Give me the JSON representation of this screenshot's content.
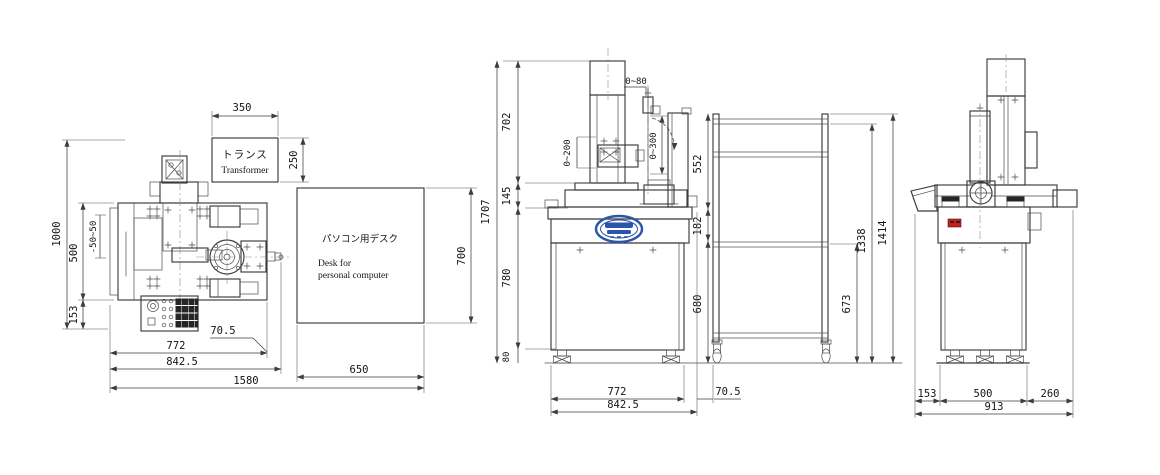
{
  "drawing_title": "machine-installation-layout-three-views",
  "colors": {
    "line": "#3a3a3a",
    "logo_blue": "#2b55a8",
    "label_red": "#bb2420"
  },
  "plan_view": {
    "transformer": {
      "label_jp": "トランス",
      "label_en": "Transformer"
    },
    "desk": {
      "label_jp": "パソコン用デスク",
      "label_en_line1": "Desk for",
      "label_en_line2": "personal computer"
    },
    "dims": {
      "transformer_width": "350",
      "transformer_depth": "250",
      "total_depth": "1000",
      "body_depth": "500",
      "table_travel": "-50~50",
      "panel_depth": "153",
      "shaft_offset": "70.5",
      "machine_width": "772",
      "machine_overall_width": "842.5",
      "desk_width": "650",
      "desk_depth": "700",
      "total_width": "1580"
    }
  },
  "front_view": {
    "dims": {
      "total_height": "1707",
      "column_height": "702",
      "column_base_height": "145",
      "cabinet_height": "780",
      "foot_height": "80",
      "head_stroke": "0~80",
      "slide_stroke": "0~200",
      "arm_stroke": "0~300",
      "frame_upper": "552",
      "frame_middle": "182",
      "frame_lower": "680",
      "shelf_height": "673",
      "frame_inner_height": "1338",
      "frame_height": "1414",
      "machine_width": "772",
      "machine_overall_width": "842.5",
      "gap_to_frame": "70.5"
    }
  },
  "side_view": {
    "dims": {
      "front_overhang": "153",
      "body_depth": "500",
      "rear_overhang": "260",
      "total_depth": "913"
    }
  }
}
